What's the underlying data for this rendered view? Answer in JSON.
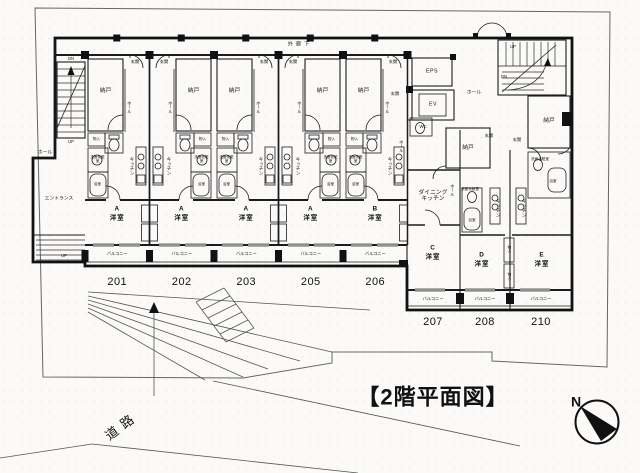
{
  "meta": {
    "title": "【2階平面図】",
    "compass": "N"
  },
  "site": {
    "road": "道路",
    "open_corridor": "外廊下"
  },
  "labels": {
    "nando": "納戸",
    "genkan": "玄関",
    "hall": "ホール",
    "kitchen": "キッチン",
    "dining_kitchen": "ダイニング キッチン",
    "room": "洋室",
    "balcony": "バルコニー",
    "closet": "物入",
    "vanity": "洗面化粧室",
    "bath": "浴室",
    "wc": "WC",
    "entrance": "エントランス",
    "eps": "EPS",
    "ev": "EV",
    "up": "UP",
    "dn": "DN"
  },
  "units": [
    {
      "number": "201",
      "letter": "A"
    },
    {
      "number": "202",
      "letter": "A"
    },
    {
      "number": "203",
      "letter": "A"
    },
    {
      "number": "205",
      "letter": "A"
    },
    {
      "number": "206",
      "letter": "B"
    },
    {
      "number": "207",
      "letter": "C"
    },
    {
      "number": "208",
      "letter": "D"
    },
    {
      "number": "210",
      "letter": "E"
    }
  ]
}
